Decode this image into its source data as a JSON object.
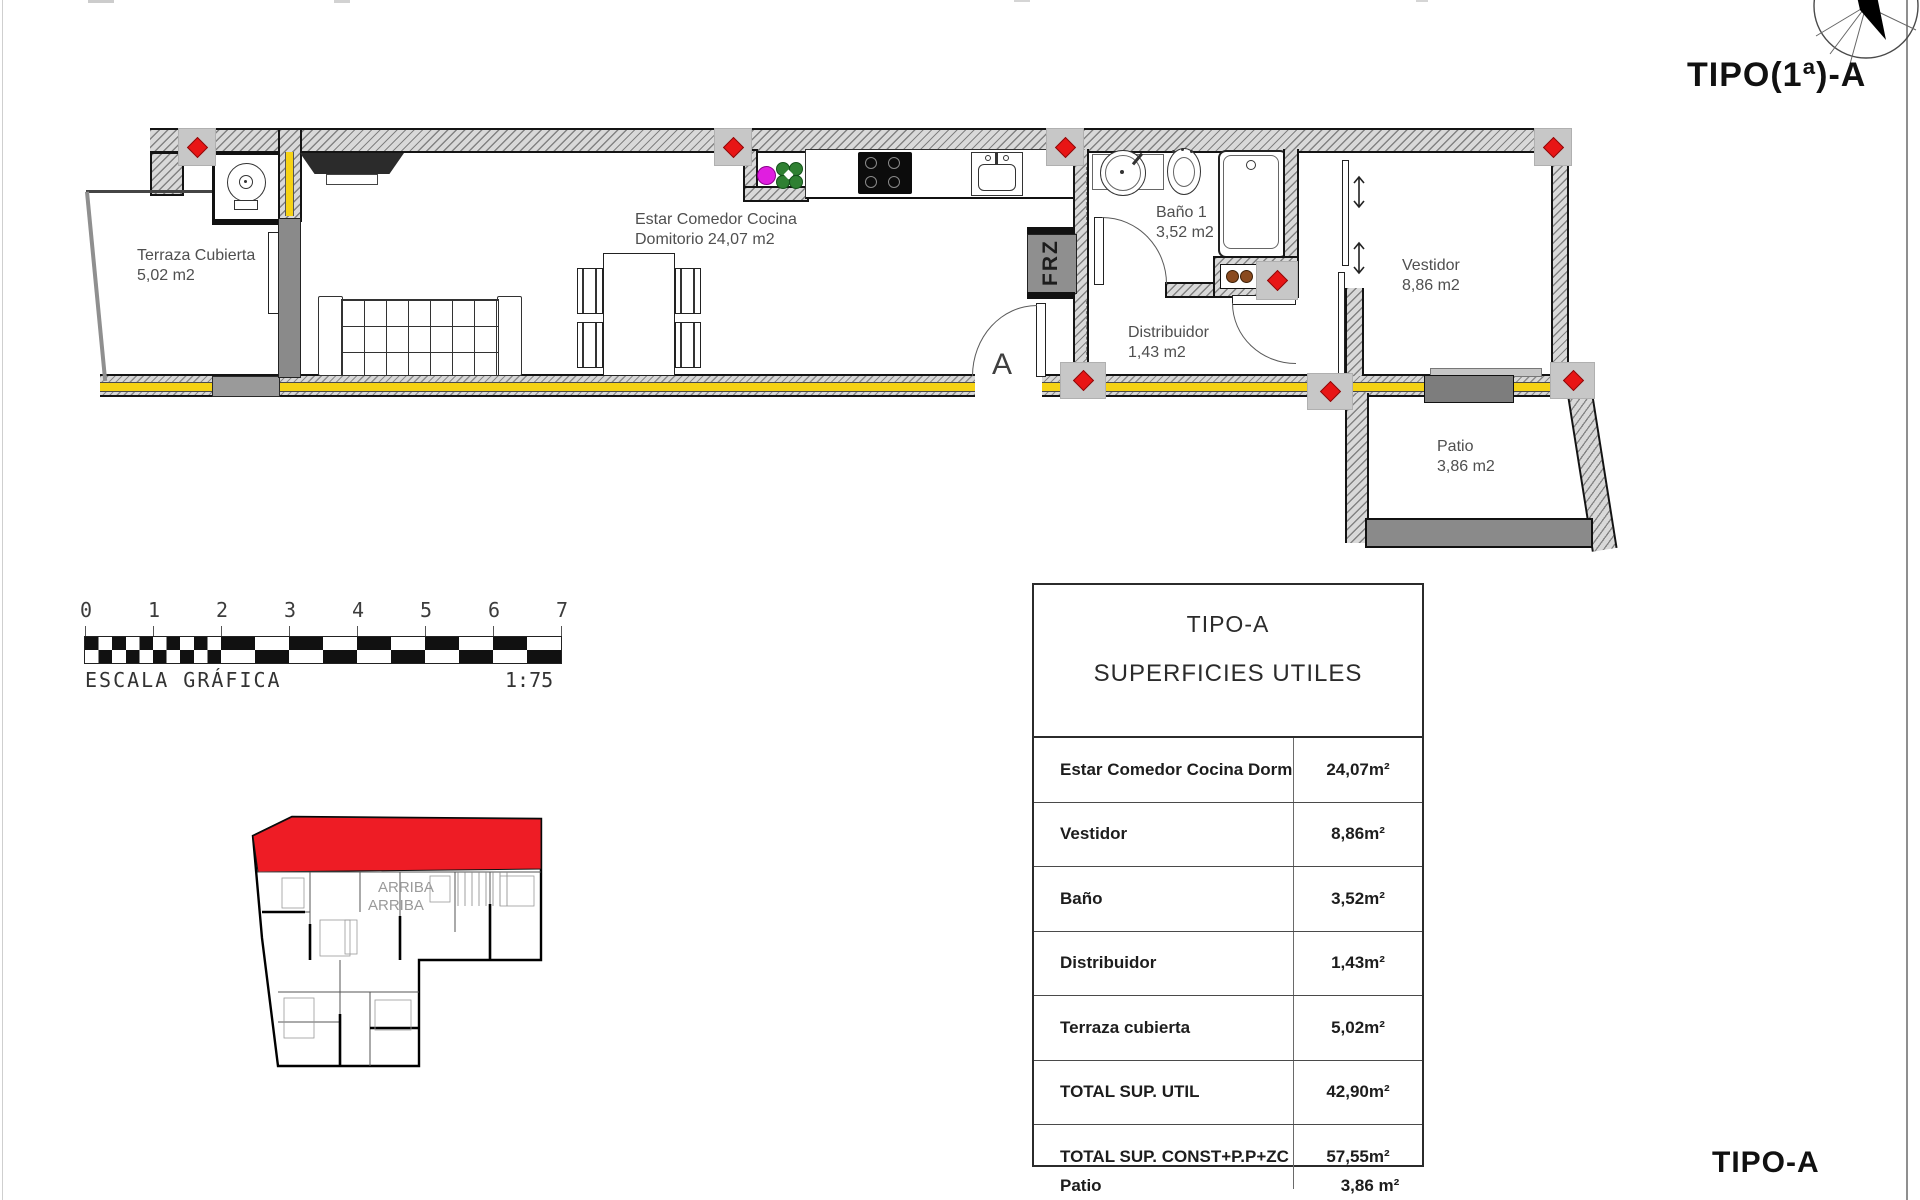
{
  "titles": {
    "plan_type_top": "TIPO(1ª)-A",
    "plan_type_bottom": "TIPO-A"
  },
  "plan": {
    "rooms": {
      "terraza": {
        "name": "Terraza Cubierta",
        "area": "5,02 m2"
      },
      "estar": {
        "name": "Estar Comedor Cocina",
        "area": "Domitorio 24,07 m2"
      },
      "bano": {
        "name": "Baño 1",
        "area": "3,52 m2"
      },
      "distribuidor": {
        "name": "Distribuidor",
        "area": "1,43 m2"
      },
      "vestidor": {
        "name": "Vestidor",
        "area": "8,86 m2"
      },
      "patio": {
        "name": "Patio",
        "area": "3,86 m2"
      }
    },
    "markers": {
      "freezer": "FRZ",
      "section": "A"
    }
  },
  "scale_bar": {
    "ticks": [
      "0",
      "1",
      "2",
      "3",
      "4",
      "5",
      "6",
      "7"
    ],
    "caption": "ESCALA GRÁFICA",
    "ratio": "1:75"
  },
  "key_plan": {
    "label_line1": "ARRIBA",
    "label_line2": "ARRIBA"
  },
  "table": {
    "title": "TIPO-A",
    "subtitle": "SUPERFICIES UTILES",
    "rows": [
      {
        "label": "Estar Comedor Cocina Dorm",
        "value": "24,07m²"
      },
      {
        "label": "Vestidor",
        "value": "8,86m²"
      },
      {
        "label": "Baño",
        "value": "3,52m²"
      },
      {
        "label": "Distribuidor",
        "value": "1,43m²"
      },
      {
        "label": "Terraza cubierta",
        "value": "5,02m²"
      },
      {
        "label": "TOTAL SUP. UTIL",
        "value": "42,90m²"
      },
      {
        "label": "TOTAL SUP. CONST+P.P+ZC",
        "value": "57,55m²"
      }
    ],
    "extra_row": {
      "label": "Patio",
      "value": "3,86 m²"
    }
  },
  "colors": {
    "highlight_red": "#ee1c25",
    "marker_red": "#e81515",
    "insulation_yellow": "#f5d214",
    "panel_gray": "#8a8a8a"
  }
}
